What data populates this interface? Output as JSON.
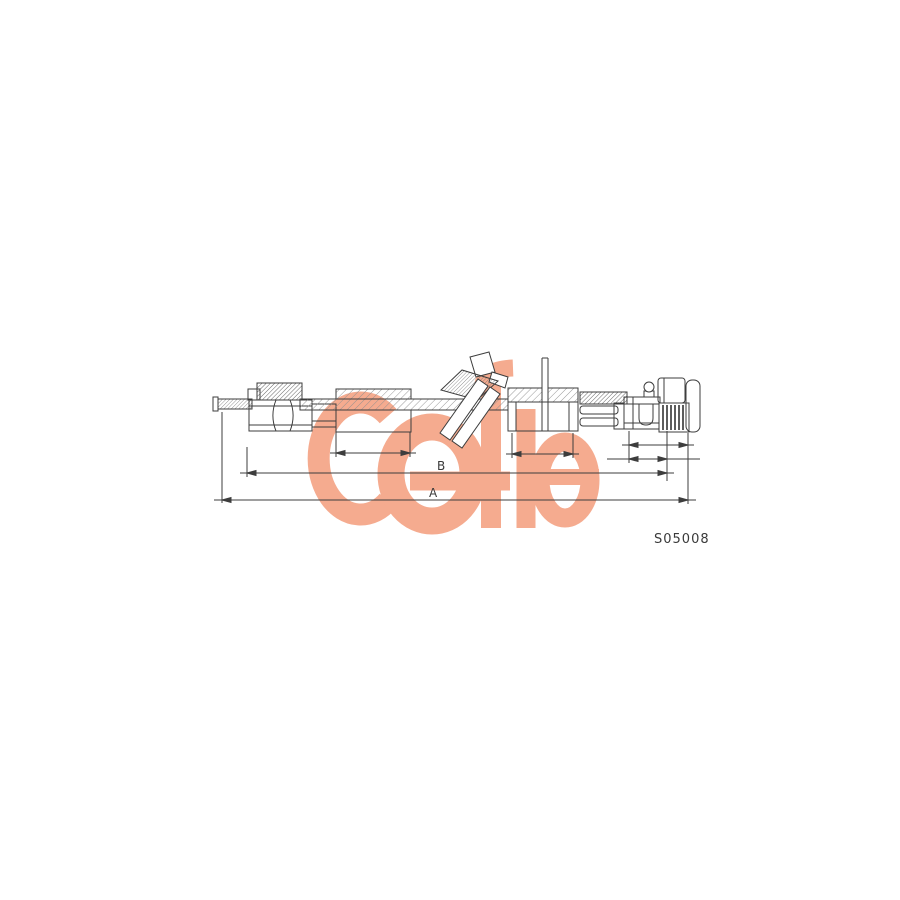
{
  "page": {
    "background": "#ffffff",
    "description": "Technical line drawing of a speedometer drive cable over a Cofle logo watermark"
  },
  "logo": {
    "text": "COfle",
    "color": "#f5ab8f"
  },
  "annotations": {
    "ink_color": "#3d3d3d",
    "dim_b": "B",
    "dim_a": "A",
    "part_number": "S05008"
  }
}
